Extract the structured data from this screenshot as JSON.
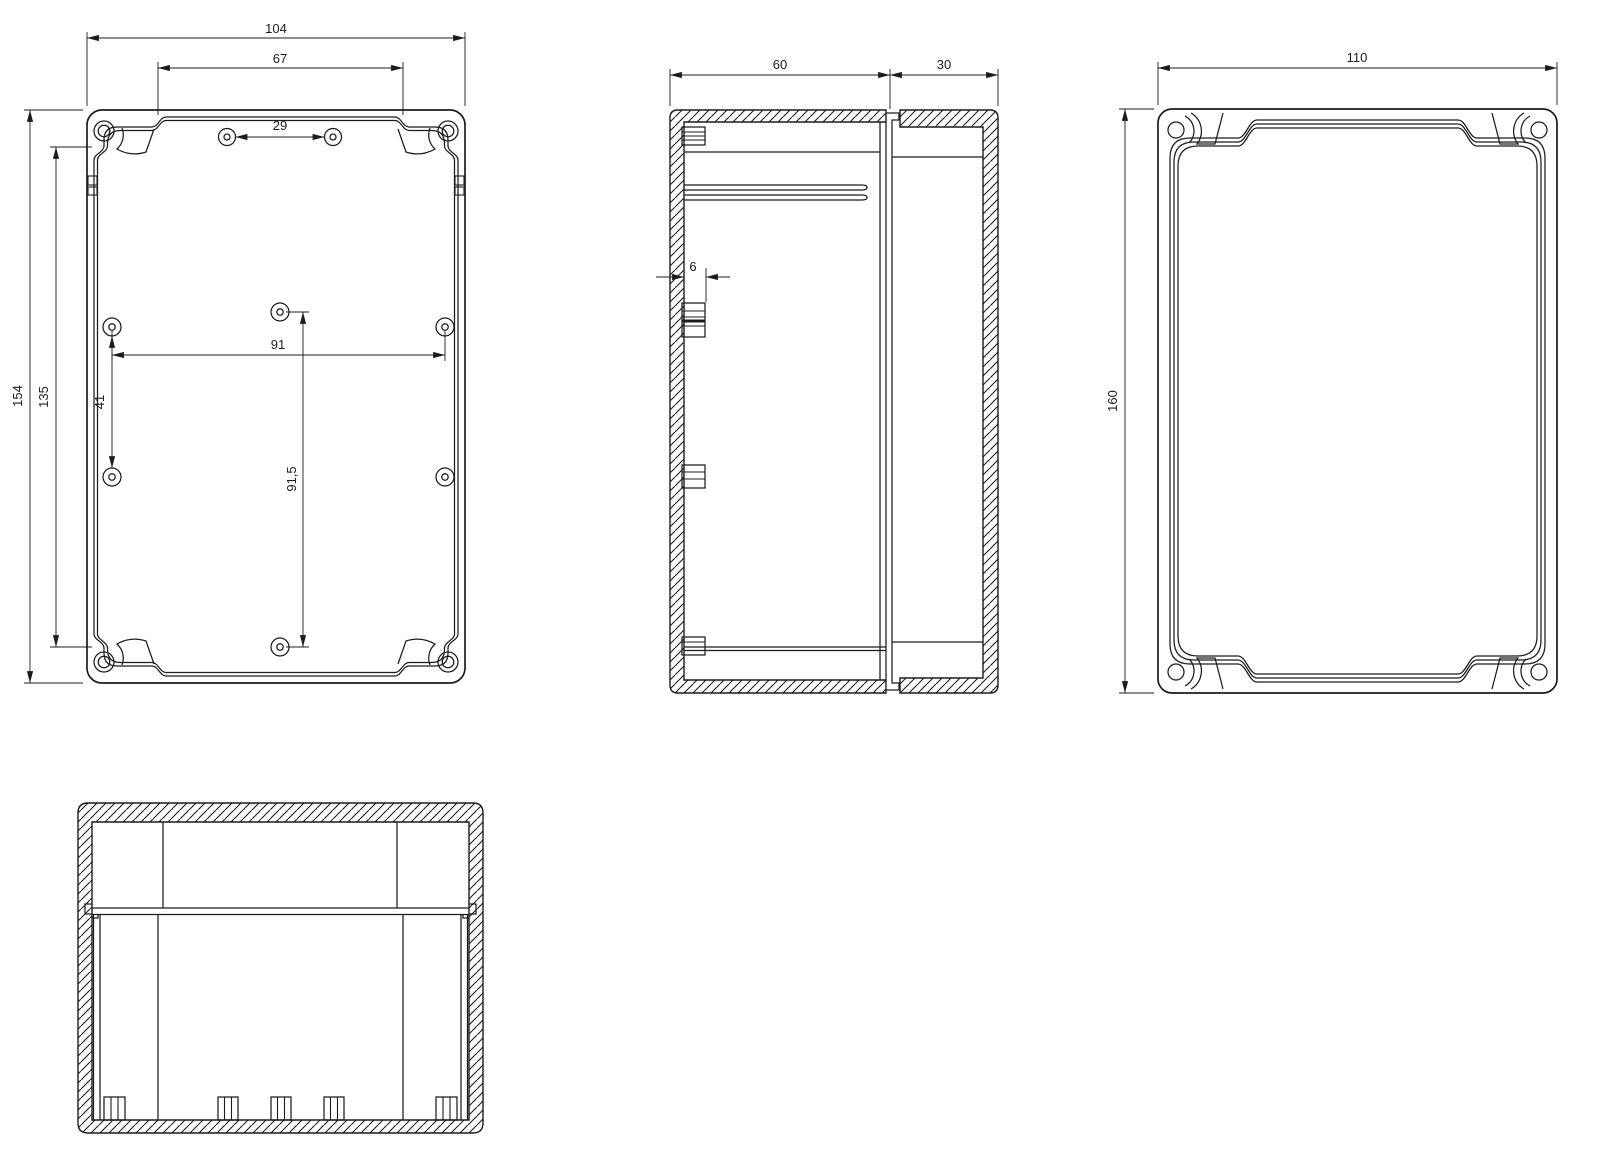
{
  "drawing": {
    "type": "technical-drawing",
    "colors": {
      "background": "#ffffff",
      "line": "#1c1c1c"
    },
    "views": {
      "bottom": {
        "name": "bottom-exterior-view",
        "dims": {
          "overall_width": "104",
          "flange_width": "67",
          "top_hole_spacing": "29",
          "overall_height": "154",
          "flange_height": "135",
          "left_hole_spacing": "41",
          "hole_span_width": "91",
          "hole_span_height": "91,5"
        }
      },
      "side_section": {
        "name": "side-section-view",
        "dims": {
          "base_depth": "60",
          "cover_depth": "30",
          "boss_width": "6"
        }
      },
      "cover": {
        "name": "cover-outside-view",
        "dims": {
          "width": "110",
          "height": "160"
        }
      },
      "front_section": {
        "name": "front-section-view"
      }
    }
  }
}
